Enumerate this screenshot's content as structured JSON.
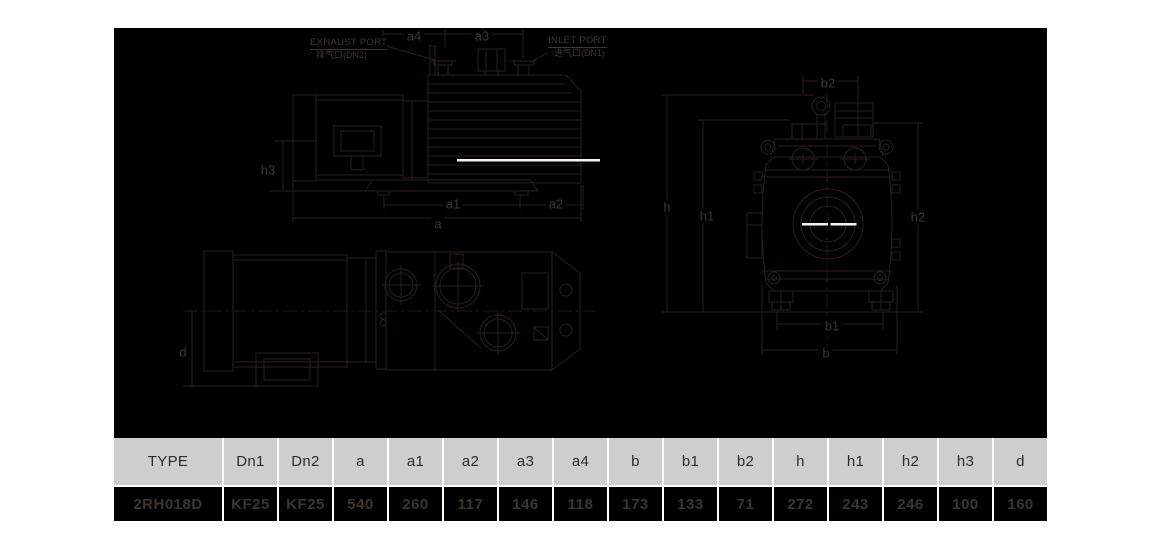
{
  "drawing": {
    "ports": {
      "exhaust": {
        "line1": "EXHAUST PORT",
        "line2": "排气口(DN2)"
      },
      "inlet": {
        "line1": "INLET PORT",
        "line2": "进气口(DN1)"
      }
    },
    "dims": {
      "a4": "a4",
      "a3": "a3",
      "h3": "h3",
      "a1": "a1",
      "a2": "a2",
      "a": "a",
      "d": "d",
      "b2": "b2",
      "h": "h",
      "h1": "h1",
      "h2": "h2",
      "b1": "b1",
      "b": "b"
    }
  },
  "table": {
    "headers": [
      "TYPE",
      "Dn1",
      "Dn2",
      "a",
      "a1",
      "a2",
      "a3",
      "a4",
      "b",
      "b1",
      "b2",
      "h",
      "h1",
      "h2",
      "h3",
      "d"
    ],
    "values": [
      "2RH018D",
      "KF25",
      "KF25",
      "540",
      "260",
      "117",
      "146",
      "118",
      "173",
      "133",
      "71",
      "272",
      "243",
      "246",
      "100",
      "160"
    ]
  },
  "colors": {
    "page_bg": "#ffffff",
    "drawing_bg": "#000000",
    "drawing_line": "#2a1f1a",
    "drawing_label": "#3e3631",
    "highlight_line": "#f4f4f4",
    "table_header_bg": "#cecece",
    "table_header_text": "#2e2d2b",
    "table_value_text": "#3c342f"
  }
}
